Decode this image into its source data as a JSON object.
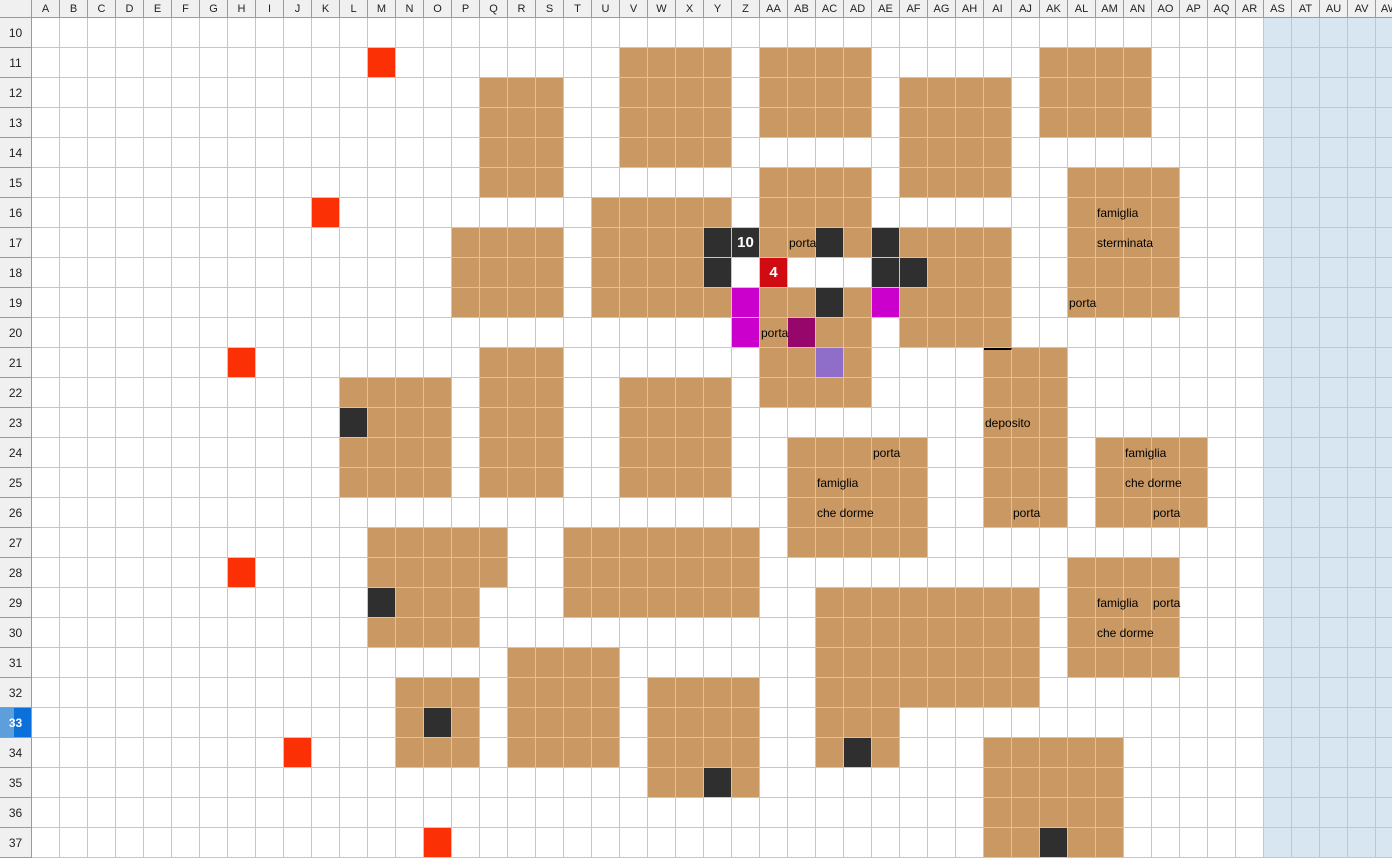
{
  "app": {
    "title": "spreadsheet map sheet"
  },
  "grid": {
    "columns": [
      "A",
      "B",
      "C",
      "D",
      "E",
      "F",
      "G",
      "H",
      "I",
      "J",
      "K",
      "L",
      "M",
      "N",
      "O",
      "P",
      "Q",
      "R",
      "S",
      "T",
      "U",
      "V",
      "W",
      "X",
      "Y",
      "Z",
      "AA",
      "AB",
      "AC",
      "AD",
      "AE",
      "AF",
      "AG",
      "AH",
      "AI",
      "AJ",
      "AK",
      "AL",
      "AM",
      "AN",
      "AO",
      "AP",
      "AQ",
      "AR",
      "AS",
      "AT",
      "AU",
      "AV",
      "AW"
    ],
    "first_row": 10,
    "last_row": 37,
    "selected_row_header": "33",
    "shaded_columns_start": "AS"
  },
  "colors": {
    "tan": "#CA9963",
    "dark": "#2F2F2F",
    "magenta": "#CC00CC",
    "dark_purple": "#96066B",
    "light_purple": "#8F6EC9",
    "marker_red": "#FB3005",
    "badge_red": "#D00B11",
    "shaded_blue": "#D8E6F2",
    "gridline": "#C6C6C6",
    "header_bg": "#F0F0F0",
    "header_border": "#9B9B9B",
    "selected_header_left": "#5C9FDB",
    "selected_header_right": "#0C70DA"
  },
  "fills": [
    {
      "color": "tan",
      "ranges": "V11:Y14 AA11:AD13 Q12:S15 AF12:AI15 AK11:AN13 AA15:AD16 U16:Y16 AL15:AO19 P17:S19 U17:X18 AA17:AB17 AD17 AF17:AI17 AG18:AI18 U19:Y19 AA19:AB19 AD19 AF19:AI19 AA20 AC20:AD20 AF20:AI20 AA21:AB21 AD21 AI21:AK26 Q21:S25 L22:O22 V22:Y25 AA22:AD22 M23:O23 L24:O25 AB24:AF27 AM24:AP26 M27:Q28 T27:Z29 N29:P29 M30:P30 AC29:AJ32 AL28:AO31 R31:U34 N32:P34 W32:Z35 AC33:AE34 AI34:AM37"
    },
    {
      "color": "dark",
      "ranges": "Y17 Z17 AC17 AE17 Y18 AE18 AF18 AC19 L23 M29 O33 AD34 Y35 AK37"
    },
    {
      "color": "magenta",
      "ranges": "Z19 AE19 Z20"
    },
    {
      "color": "dark_purple",
      "ranges": "AB20"
    },
    {
      "color": "light_purple",
      "ranges": "AC21"
    },
    {
      "color": "marker_red",
      "ranges": "M11 K16 H21 H28 J34 O37"
    },
    {
      "color": "badge_red",
      "ranges": "AA18"
    }
  ],
  "badges": [
    {
      "cell": "Z17",
      "text": "10"
    },
    {
      "cell": "AA18",
      "text": "4"
    }
  ],
  "labels": [
    {
      "cell": "AB17",
      "text": "porta"
    },
    {
      "cell": "AM16",
      "text": "famiglia"
    },
    {
      "cell": "AM17",
      "text": "sterminata"
    },
    {
      "cell": "AL19",
      "text": "porta"
    },
    {
      "cell": "AA20",
      "text": "porta"
    },
    {
      "cell": "AI23",
      "text": "deposito"
    },
    {
      "cell": "AE24",
      "text": "porta"
    },
    {
      "cell": "AC25",
      "text": "famiglia"
    },
    {
      "cell": "AC26",
      "text": "che dorme"
    },
    {
      "cell": "AN24",
      "text": "famiglia"
    },
    {
      "cell": "AN25",
      "text": "che dorme"
    },
    {
      "cell": "AJ26",
      "text": "porta"
    },
    {
      "cell": "AO26",
      "text": "porta"
    },
    {
      "cell": "AM29",
      "text": "famiglia"
    },
    {
      "cell": "AO29",
      "text": "porta"
    },
    {
      "cell": "AM30",
      "text": "che dorme"
    }
  ],
  "special_borders": [
    {
      "cell": "AI21",
      "side": "top"
    }
  ]
}
